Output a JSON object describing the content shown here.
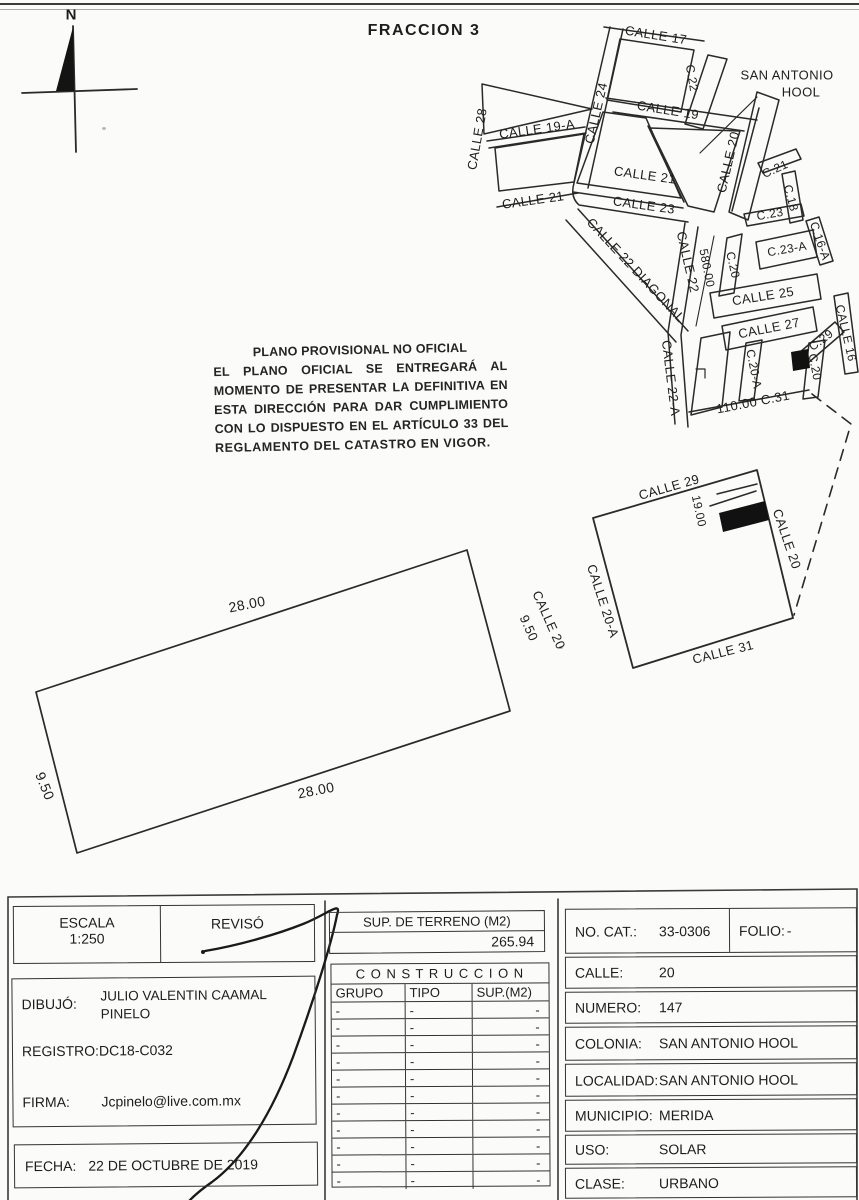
{
  "page": {
    "title": "FRACCION 3",
    "north_label": "N"
  },
  "disclaimer": {
    "lines": [
      "PLANO PROVISIONAL NO OFICIAL",
      "EL PLANO OFICIAL SE ENTREGARÁ AL",
      "MOMENTO DE PRESENTAR LA DEFINITIVA EN",
      "ESTA DIRECCIÓN PARA DAR CUMPLIMIENTO",
      "CON LO DISPUESTO EN EL ARTÍCULO 33 DEL",
      "REGLAMENTO DEL CATASTRO EN VIGOR."
    ]
  },
  "overview_map": {
    "labels": [
      "CALLE 17",
      "C.22",
      "SAN ANTONIO",
      "HOOL",
      "CALLE 24",
      "CALLE 19",
      "CALLE 28",
      "CALLE 19-A",
      "CALLE 20",
      "C.21",
      "CALLE 21",
      "CALLE 21",
      "CALLE 23",
      "C.18",
      "C.23",
      "CALLE 22 DIAGONAL",
      "CALLE 22",
      "580.00",
      "C.20",
      "C.23-A",
      "C.16-A",
      "CALLE 25",
      "CALLE 27",
      "C.29",
      "CALLE 16",
      "CALLE 22-A",
      "C.20-A",
      "C.20",
      "110.00  C.31"
    ]
  },
  "location_map": {
    "street_top": "CALLE 29",
    "lot_depth": "19.00",
    "street_right": "CALLE 20",
    "street_left": "CALLE 20-A",
    "street_bottom": "CALLE 31"
  },
  "parcel": {
    "dim_top": "28.00",
    "dim_bottom": "28.00",
    "dim_left": "9.50",
    "dim_right": "9.50",
    "street": "CALLE 20"
  },
  "titleblock": {
    "escala_label": "ESCALA",
    "escala_value": "1:250",
    "reviso_label": "REVISÓ",
    "dibujo_label": "DIBUJÓ:",
    "dibujo_value_line1": "JULIO VALENTIN CAAMAL",
    "dibujo_value_line2": "PINELO",
    "registro_label": "REGISTRO:",
    "registro_value": "DC18-C032",
    "firma_label": "FIRMA:",
    "firma_value": "Jcpinelo@live.com.mx",
    "fecha_label": "FECHA:",
    "fecha_value": "22 DE OCTUBRE DE 2019"
  },
  "terreno": {
    "header": "SUP. DE TERRENO (M2)",
    "value": "265.94"
  },
  "construccion": {
    "title": "C O N S T R U C C I O N",
    "columns": [
      "GRUPO",
      "TIPO",
      "SUP.(M2)"
    ],
    "rows": [
      [
        "-",
        "-",
        "-"
      ],
      [
        "-",
        "-",
        "-"
      ],
      [
        "-",
        "-",
        "-"
      ],
      [
        "-",
        "-",
        "-"
      ],
      [
        "-",
        "-",
        "-"
      ],
      [
        "-",
        "-",
        "-"
      ],
      [
        "-",
        "-",
        "-"
      ],
      [
        "-",
        "-",
        "-"
      ],
      [
        "-",
        "-",
        "-"
      ],
      [
        "-",
        "-",
        "-"
      ],
      [
        "-",
        "-",
        "-"
      ]
    ]
  },
  "cadastre": {
    "no_cat_label": "NO. CAT.:",
    "no_cat_value": "33-0306",
    "folio_label": "FOLIO:",
    "folio_value": "-",
    "calle_label": "CALLE:",
    "calle_value": "20",
    "numero_label": "NUMERO:",
    "numero_value": "147",
    "colonia_label": "COLONIA:",
    "colonia_value": "SAN ANTONIO HOOL",
    "localidad_label": "LOCALIDAD:",
    "localidad_value": "SAN ANTONIO HOOL",
    "municipio_label": "MUNICIPIO:",
    "municipio_value": "MERIDA",
    "uso_label": "USO:",
    "uso_value": "SOLAR",
    "clase_label": "CLASE:",
    "clase_value": "URBANO"
  }
}
